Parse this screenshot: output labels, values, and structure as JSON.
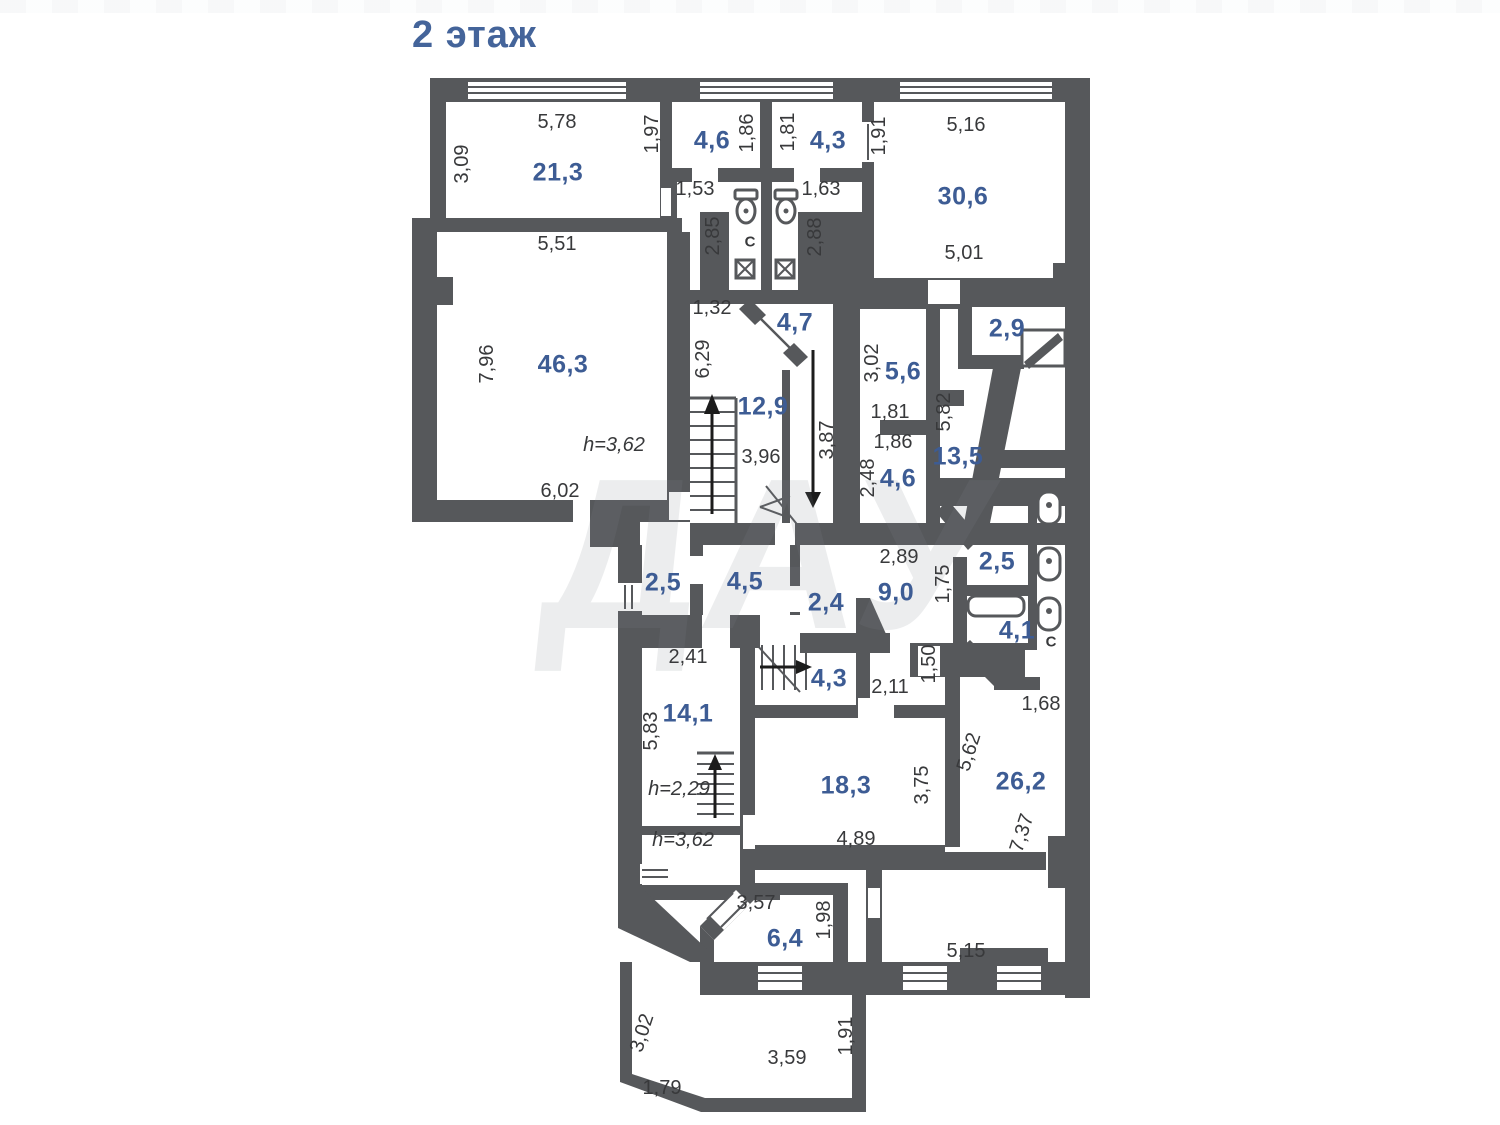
{
  "title": "2 этаж",
  "watermark": "ДАУ",
  "colors": {
    "wall": "#56585b",
    "accent": "#44649a",
    "area_text": "#3d5c94",
    "dim_text": "#38393b"
  },
  "floorplan": {
    "rooms": [
      {
        "id": "21-3",
        "area": "21,3",
        "x": 558,
        "y": 173
      },
      {
        "id": "4-6-top",
        "area": "4,6",
        "x": 712,
        "y": 141
      },
      {
        "id": "4-3-top",
        "area": "4,3",
        "x": 828,
        "y": 141
      },
      {
        "id": "30-6",
        "area": "30,6",
        "x": 963,
        "y": 197
      },
      {
        "id": "46-3",
        "area": "46,3",
        "x": 563,
        "y": 365
      },
      {
        "id": "4-7",
        "area": "4,7",
        "x": 795,
        "y": 323
      },
      {
        "id": "12-9",
        "area": "12,9",
        "x": 763,
        "y": 407
      },
      {
        "id": "5-6",
        "area": "5,6",
        "x": 903,
        "y": 372
      },
      {
        "id": "2-9",
        "area": "2,9",
        "x": 1007,
        "y": 329
      },
      {
        "id": "13-5",
        "area": "13,5",
        "x": 958,
        "y": 457
      },
      {
        "id": "4-6-mid",
        "area": "4,6",
        "x": 898,
        "y": 479
      },
      {
        "id": "2-5-left",
        "area": "2,5",
        "x": 663,
        "y": 583
      },
      {
        "id": "4-5",
        "area": "4,5",
        "x": 745,
        "y": 582
      },
      {
        "id": "2-4",
        "area": "2,4",
        "x": 826,
        "y": 603
      },
      {
        "id": "9-0",
        "area": "9,0",
        "x": 896,
        "y": 593
      },
      {
        "id": "2-5-right",
        "area": "2,5",
        "x": 997,
        "y": 562
      },
      {
        "id": "4-1",
        "area": "4,1",
        "x": 1017,
        "y": 631
      },
      {
        "id": "14-1",
        "area": "14,1",
        "x": 688,
        "y": 714
      },
      {
        "id": "4-3-low",
        "area": "4,3",
        "x": 829,
        "y": 679
      },
      {
        "id": "18-3",
        "area": "18,3",
        "x": 846,
        "y": 786
      },
      {
        "id": "26-2",
        "area": "26,2",
        "x": 1021,
        "y": 782
      },
      {
        "id": "6-4",
        "area": "6,4",
        "x": 785,
        "y": 939
      }
    ],
    "dimensions": [
      {
        "text": "5,78",
        "x": 557,
        "y": 122,
        "rot": 0
      },
      {
        "text": "3,09",
        "x": 462,
        "y": 164,
        "rot": -90
      },
      {
        "text": "1,97",
        "x": 652,
        "y": 134,
        "rot": -90
      },
      {
        "text": "1,86",
        "x": 747,
        "y": 133,
        "rot": -90
      },
      {
        "text": "1,81",
        "x": 788,
        "y": 132,
        "rot": -90
      },
      {
        "text": "1,91",
        "x": 879,
        "y": 136,
        "rot": -90
      },
      {
        "text": "5,16",
        "x": 966,
        "y": 125,
        "rot": 0
      },
      {
        "text": "1,53",
        "x": 695,
        "y": 189,
        "rot": 0
      },
      {
        "text": "1,63",
        "x": 821,
        "y": 189,
        "rot": 0
      },
      {
        "text": "2,85",
        "x": 713,
        "y": 236,
        "rot": -90
      },
      {
        "text": "2,88",
        "x": 815,
        "y": 237,
        "rot": -90
      },
      {
        "text": "5,01",
        "x": 964,
        "y": 253,
        "rot": 0
      },
      {
        "text": "5,51",
        "x": 557,
        "y": 244,
        "rot": 0
      },
      {
        "text": "1,32",
        "x": 712,
        "y": 308,
        "rot": 0
      },
      {
        "text": "7,96",
        "x": 487,
        "y": 364,
        "rot": -90
      },
      {
        "text": "6,29",
        "x": 703,
        "y": 359,
        "rot": -90
      },
      {
        "text": "3,02",
        "x": 872,
        "y": 363,
        "rot": -90
      },
      {
        "text": "1,81",
        "x": 890,
        "y": 412,
        "rot": 0
      },
      {
        "text": "5,82",
        "x": 944,
        "y": 412,
        "rot": -90
      },
      {
        "text": "3,96",
        "x": 761,
        "y": 457,
        "rot": 0
      },
      {
        "text": "3,87",
        "x": 827,
        "y": 440,
        "rot": -90
      },
      {
        "text": "1,86",
        "x": 893,
        "y": 442,
        "rot": 0
      },
      {
        "text": "2,48",
        "x": 868,
        "y": 478,
        "rot": -90
      },
      {
        "text": "6,02",
        "x": 560,
        "y": 491,
        "rot": 0
      },
      {
        "text": "2,89",
        "x": 899,
        "y": 557,
        "rot": 0
      },
      {
        "text": "1,75",
        "x": 943,
        "y": 584,
        "rot": -90
      },
      {
        "text": "2,41",
        "x": 688,
        "y": 657,
        "rot": 0
      },
      {
        "text": "5,83",
        "x": 651,
        "y": 731,
        "rot": -90
      },
      {
        "text": "2,11",
        "x": 890,
        "y": 687,
        "rot": 0
      },
      {
        "text": "1,50",
        "x": 929,
        "y": 664,
        "rot": -90
      },
      {
        "text": "1,68",
        "x": 1041,
        "y": 704,
        "rot": 0
      },
      {
        "text": "5,62",
        "x": 969,
        "y": 752,
        "rot": -72
      },
      {
        "text": "3,75",
        "x": 922,
        "y": 785,
        "rot": -90
      },
      {
        "text": "4,89",
        "x": 856,
        "y": 839,
        "rot": 0
      },
      {
        "text": "7,37",
        "x": 1022,
        "y": 833,
        "rot": -72
      },
      {
        "text": "3,57",
        "x": 756,
        "y": 903,
        "rot": 0
      },
      {
        "text": "1,98",
        "x": 824,
        "y": 920,
        "rot": -90
      },
      {
        "text": "5,15",
        "x": 966,
        "y": 951,
        "rot": 0
      },
      {
        "text": "3,02",
        "x": 642,
        "y": 1033,
        "rot": -72
      },
      {
        "text": "3,59",
        "x": 787,
        "y": 1058,
        "rot": 0
      },
      {
        "text": "1,79",
        "x": 662,
        "y": 1088,
        "rot": 0
      },
      {
        "text": "1,91",
        "x": 846,
        "y": 1036,
        "rot": -90
      }
    ],
    "heights": [
      {
        "text": "h=3,62",
        "x": 614,
        "y": 445
      },
      {
        "text": "h=2,29",
        "x": 679,
        "y": 789
      },
      {
        "text": "h=3,62",
        "x": 683,
        "y": 840
      }
    ],
    "symbols": [
      {
        "text": "C",
        "x": 750,
        "y": 242
      },
      {
        "text": "C",
        "x": 1051,
        "y": 642
      }
    ]
  }
}
